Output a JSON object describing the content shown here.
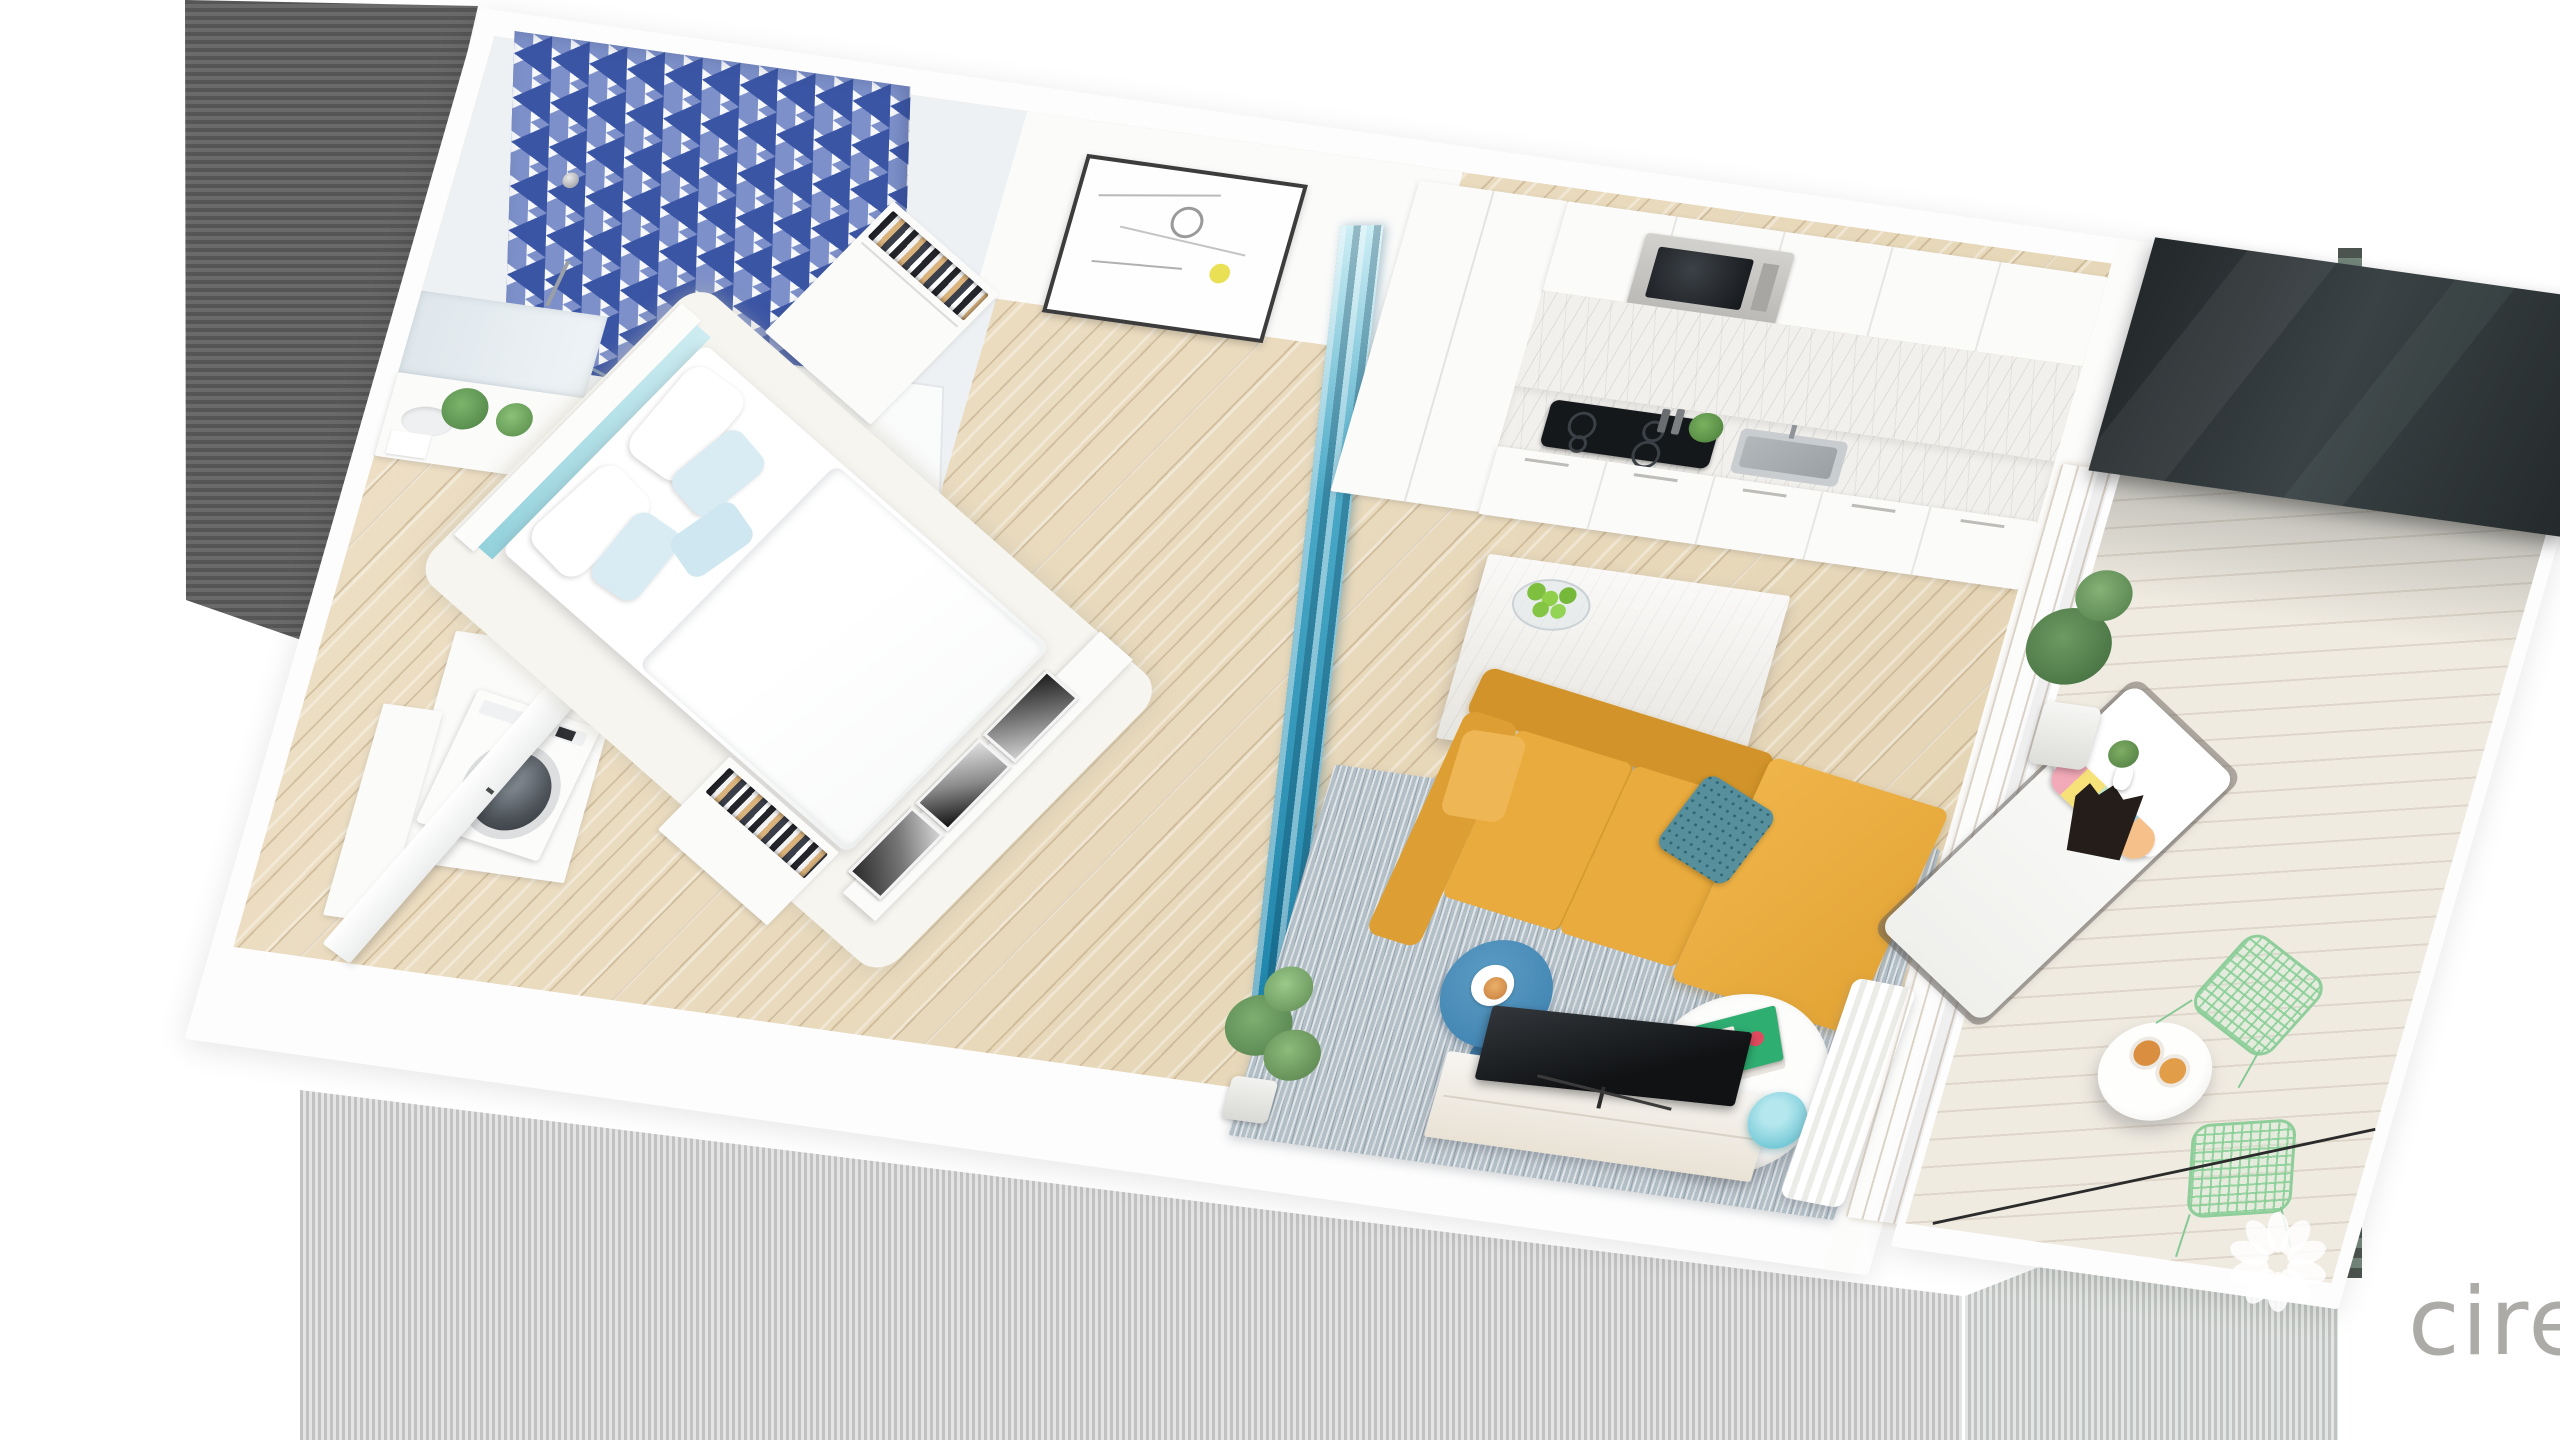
{
  "image": {
    "type": "3d-floorplan-cutaway-render",
    "subject": "studio apartment",
    "view": "aerial dollhouse perspective"
  },
  "texts": {
    "watermark": "cire",
    "book_title": "TULUM"
  },
  "watermark": {
    "logo": "petal-flower-logo",
    "text": "cire"
  },
  "palette": {
    "sofa_mustard": "#E9AB3D",
    "divider_teal": "#2E9CBE",
    "tile_blue": "#3B55A5",
    "headboard_blue": "#BFE7EC",
    "wood_floor": "#E8DCC1",
    "rug_gray": "#B3BFC7",
    "chair_mint": "#9AD4A4",
    "lamp_teal": "#79CBD8",
    "side_table_blue": "#4587B5",
    "book_green": "#2FAE72",
    "watermark_gray": "#A8A7A3",
    "glass_dark": "#2E3537"
  },
  "rooms": [
    {
      "name": "bathroom",
      "items": [
        "triangle-tile-feature-wall",
        "walk-in-shower",
        "shower-glass-panel",
        "rain-shower-head",
        "hand-shower-bar",
        "toilet",
        "vanity-with-mirror",
        "potted-plants",
        "towels"
      ]
    },
    {
      "name": "entry-hall",
      "items": [
        "open-door",
        "second-door-leaf",
        "laundry-niche",
        "washing-machine",
        "tall-cabinet",
        "wood-floor"
      ]
    },
    {
      "name": "bedroom",
      "items": [
        "teal-upholstered-headboard",
        "double-bed",
        "white-pillows",
        "light-blue-pillows",
        "white-shag-rug",
        "open-wardrobe-head",
        "open-wardrobe-foot",
        "abstract-wall-art",
        "bw-photo-triptych",
        "accordion-room-divider"
      ]
    },
    {
      "name": "kitchen",
      "items": [
        "tall-cabinet-column",
        "upper-cabinets",
        "built-in-microwave",
        "marble-backsplash",
        "black-cooktop",
        "spice-grinders",
        "herb-plant",
        "stainless-sink",
        "base-cabinets",
        "marble-island",
        "fruit-bowl-with-limes"
      ]
    },
    {
      "name": "living-room",
      "items": [
        "mustard-sectional-sofa",
        "teal-patterned-pillow",
        "blue-round-side-table",
        "coffee-cup",
        "white-marble-coffee-table",
        "green-travel-book",
        "gray-area-rug",
        "tv-console",
        "flat-screen-tv",
        "teal-table-lamp",
        "potted-plant",
        "white-curtain"
      ]
    },
    {
      "name": "balcony",
      "items": [
        "wood-slat-divider",
        "dark-glass-wall",
        "whitewashed-deck",
        "white-chaise-lounge",
        "multicolor-bolster-pillow",
        "rubber-plant-white-pot",
        "black-faceted-vase",
        "mini-white-vase",
        "round-bistro-table",
        "two-drink-glasses",
        "green-wire-chair",
        "green-wire-chair",
        "glass-balustrade"
      ]
    }
  ]
}
